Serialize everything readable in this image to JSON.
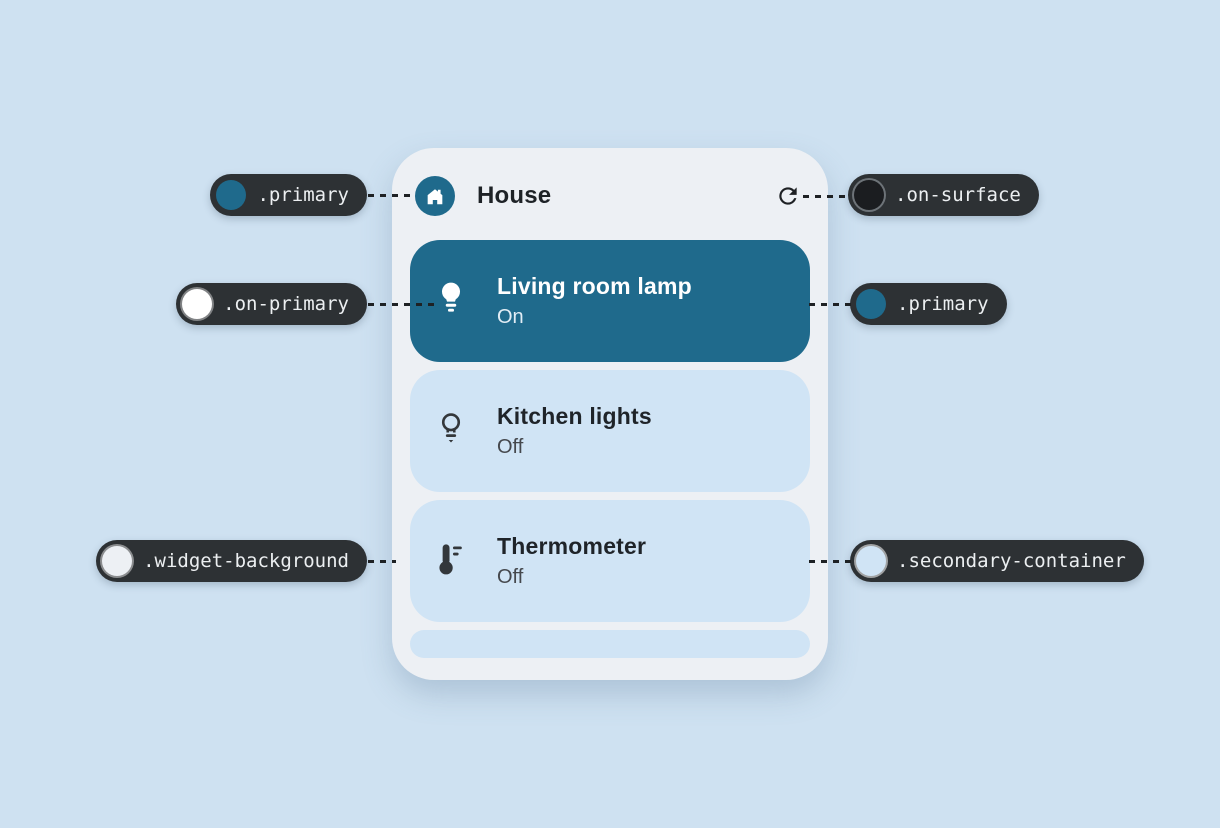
{
  "page": {
    "background": "#cee1f1"
  },
  "widget": {
    "title": "House",
    "header_icon": "house-icon",
    "refresh_icon": "refresh-icon",
    "background": "#edf0f4",
    "devices": [
      {
        "name": "Living room lamp",
        "status": "On",
        "icon": "lightbulb-filled-icon",
        "active": true,
        "background": "#1f6a8c"
      },
      {
        "name": "Kitchen lights",
        "status": "Off",
        "icon": "lightbulb-outline-icon",
        "active": false,
        "background": "#d0e4f5"
      },
      {
        "name": "Thermometer",
        "status": "Off",
        "icon": "thermometer-icon",
        "active": false,
        "background": "#d0e4f5"
      }
    ]
  },
  "annotations": [
    {
      "label": ".primary",
      "swatch": "#1f6a8c",
      "ring": "transparent",
      "side": "left",
      "points_to": "house app badge"
    },
    {
      "label": ".on-surface",
      "swatch": "#1b1d20",
      "ring": "#6d7378",
      "side": "right",
      "points_to": "refresh icon"
    },
    {
      "label": ".on-primary",
      "swatch": "#ffffff",
      "ring": "rgba(255,255,255,0.4)",
      "side": "left",
      "points_to": "lamp icon on active card"
    },
    {
      "label": ".primary",
      "swatch": "#1f6a8c",
      "ring": "transparent",
      "side": "right",
      "points_to": "active device card"
    },
    {
      "label": ".widget-background",
      "swatch": "#edf0f4",
      "ring": "rgba(255,255,255,0.45)",
      "side": "left",
      "points_to": "widget surface"
    },
    {
      "label": ".secondary-container",
      "swatch": "#d0e4f5",
      "ring": "rgba(255,255,255,0.55)",
      "side": "right",
      "points_to": "inactive device card"
    }
  ],
  "colors": {
    "primary": "#1f6a8c",
    "on_primary": "#ffffff",
    "on_surface": "#1b1d20",
    "widget_background": "#edf0f4",
    "secondary_container": "#d0e4f5",
    "annotation_pill": "#2d3134",
    "dotted_line": "#1e2124"
  }
}
